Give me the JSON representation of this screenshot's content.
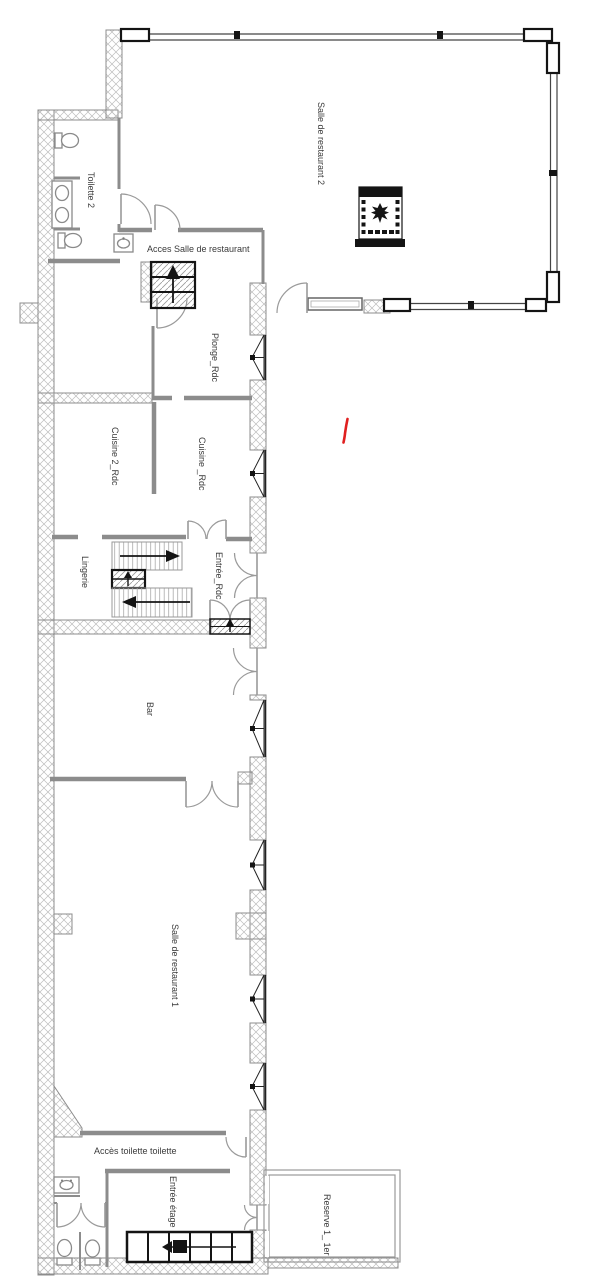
{
  "plan": {
    "rooms": {
      "salle2": "Salle de restaurant 2",
      "toilette2": "Toilette 2",
      "acces_salle": "Acces Salle de restaurant",
      "plonge": "Plonge_Rdc",
      "cuisine2": "Cuisine 2_Rdc",
      "cuisine": "Cuisine _Rdc",
      "lingerie": "Lingerie",
      "entree_rdc": "Entrée_Rdc",
      "bar": "Bar",
      "salle1": "Salle de restaurant 1",
      "acces_toilette": "Accès toilette toilette",
      "entree_etage": "Entrée étage",
      "reserve": "Reserve 1_ 1er"
    },
    "colors": {
      "bg": "#ffffff",
      "wall": "#8c8c8c",
      "hatch": "#bdbdbd",
      "black": "#141414",
      "red": "#e02020",
      "label": "#3a3a3a"
    },
    "symbols": {
      "window": "casement-window-icon",
      "door": "door-swing-icon",
      "stairs": "staircase-icon",
      "toilet": "toilet-icon",
      "sink": "sink-icon",
      "fireplace": "fireplace-icon",
      "annotation": "red-pen-mark"
    }
  }
}
